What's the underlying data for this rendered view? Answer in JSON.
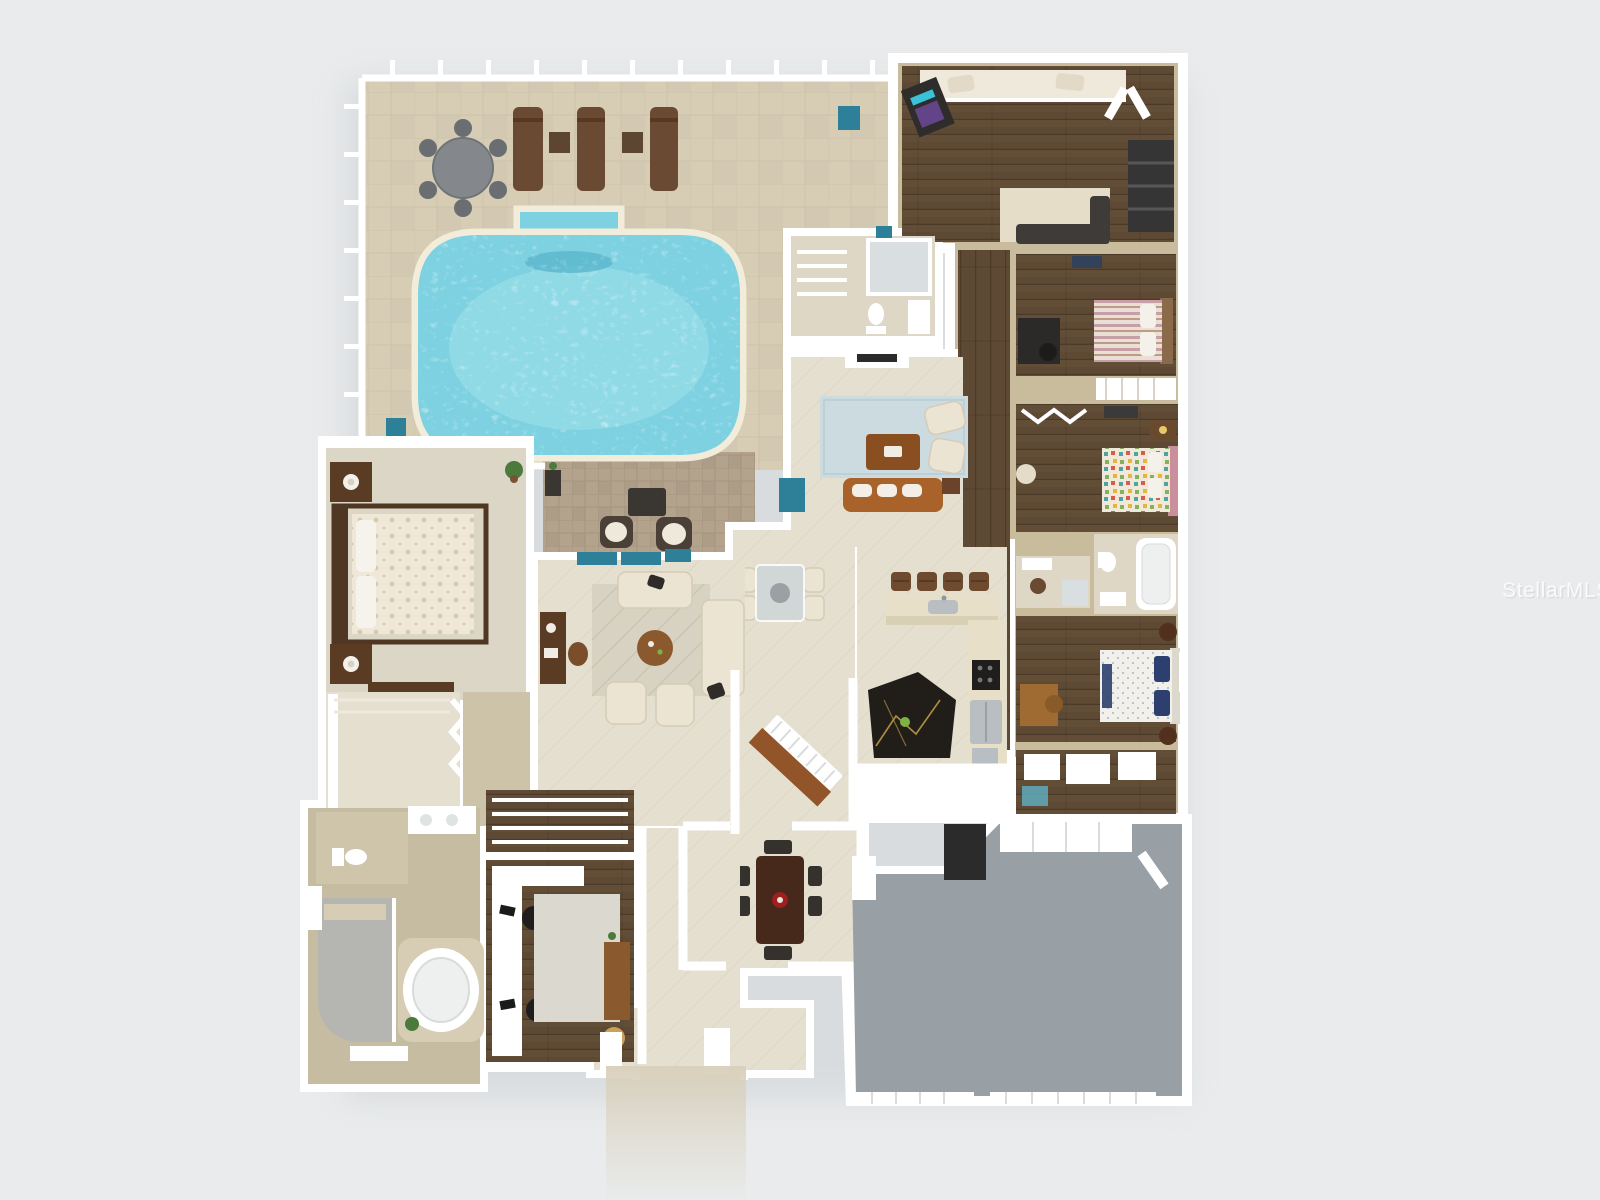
{
  "watermark": {
    "text": "StellarMLS"
  },
  "colors": {
    "background": "#e9ebec",
    "wall": "#ffffff",
    "wall_tan": "#c9bc9c",
    "shadow": "#c9ced2",
    "deck": "#d7ccb4",
    "deck_line": "#c4b9a1",
    "paver": "#b3a28c",
    "paver_line": "#9c8d77",
    "pool_water": "#7dd1e1",
    "pool_water_light": "#a9e4ee",
    "pool_coping": "#f2ecdb",
    "pool_step": "#5fb9cf",
    "tile": "#e5dfd0",
    "tile_line": "#d6cfbc",
    "tile_light": "#ded7c6",
    "tile_gold": "#cdc3a8",
    "wood": "#5d4934",
    "wood_dark": "#4b3a28",
    "carpet": "#dbd6c6",
    "carpet_light": "#e5dfd0",
    "bath_tile": "#c6bca2",
    "shower": "#b5b5b1",
    "garage": "#98a0a6",
    "rug_blue": "#ccdbe0",
    "rug_cream": "#d8d2c2",
    "rug_office": "#dad8cf",
    "sofa_cream": "#ece4d3",
    "sofa_cream_edge": "#d5cbb6",
    "sofa_caramel": "#a9632a",
    "ottoman": "#8a4f21",
    "furn_dark": "#3a3733",
    "furn_black": "#23211f",
    "wood_furn": "#5a3b24",
    "wood_furn_light": "#8a5a2e",
    "marble_black": "#211d18",
    "marble_vein": "#c8a24a",
    "glass_teal": "#2e7f98",
    "glass_teal_light": "#5fb3c4",
    "metal": "#b9bec2",
    "table_gray": "#84888c",
    "lounge_brown": "#6b4a33",
    "bed_stripe": "#c79fa6",
    "bed_navy": "#2c3f6e",
    "accent_red": "#9e1f1f",
    "plant_green": "#4c7a3d",
    "watermark": "#ffffff"
  }
}
